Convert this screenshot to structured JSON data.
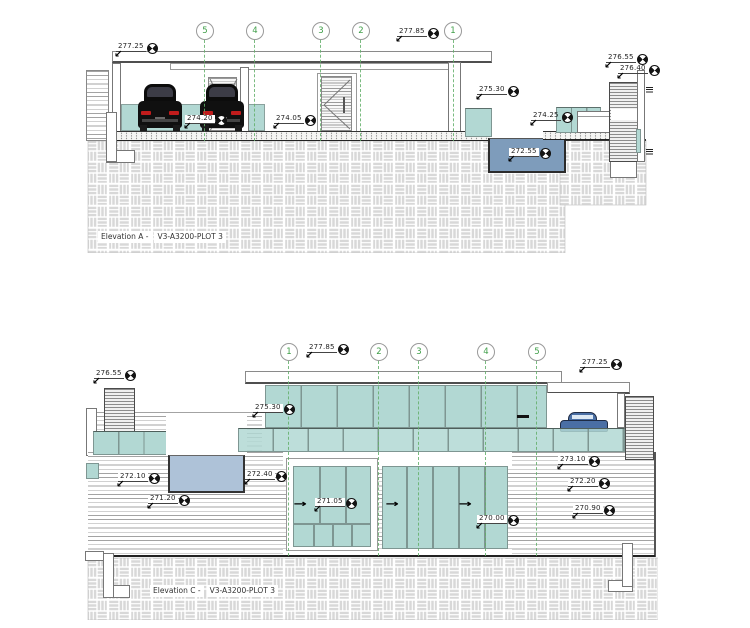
{
  "icons": {
    "leader_arrow": "↙",
    "slide_arrow": "→"
  },
  "colors": {
    "glass_teal": "#b2d8d3",
    "pool_deep": "#7e9cbb",
    "pool_shallow": "#aec2d8",
    "ground_grey": "#d8d8d8",
    "grid_green": "#3e9e47",
    "car_black": "#101010",
    "car_blue": "#4a6fa5",
    "taillight_red": "#c11c1c"
  },
  "elevation_a": {
    "caption": {
      "name": "Elevation A -",
      "doc": "V3-A3200-PLOT 3"
    },
    "grid_bubbles": [
      "5",
      "4",
      "3",
      "2",
      "1"
    ],
    "levels": {
      "parapet": "277.25",
      "roof": "277.85",
      "rear_wall_top": "276.55",
      "rear_wall": "276.40",
      "balustrade": "275.30",
      "garage_slab": "274.20",
      "entry_slab": "274.05",
      "pool_deck": "274.25",
      "pool_base": "272.55"
    }
  },
  "elevation_c": {
    "caption": {
      "name": "Elevation C -",
      "doc": "V3-A3200-PLOT 3"
    },
    "grid_bubbles": [
      "1",
      "2",
      "3",
      "4",
      "5"
    ],
    "levels": {
      "roof": "277.85",
      "carport_parapet": "277.25",
      "chimney_top": "276.55",
      "clerestory_sill": "275.30",
      "wall_step_upper": "273.10",
      "terrace_upper": "272.10",
      "terrace_step": "272.40",
      "wall_step_mid": "272.20",
      "garden_left": "271.20",
      "floor_level": "271.05",
      "wall_step_lower": "270.90",
      "ground_level": "270.00"
    }
  }
}
